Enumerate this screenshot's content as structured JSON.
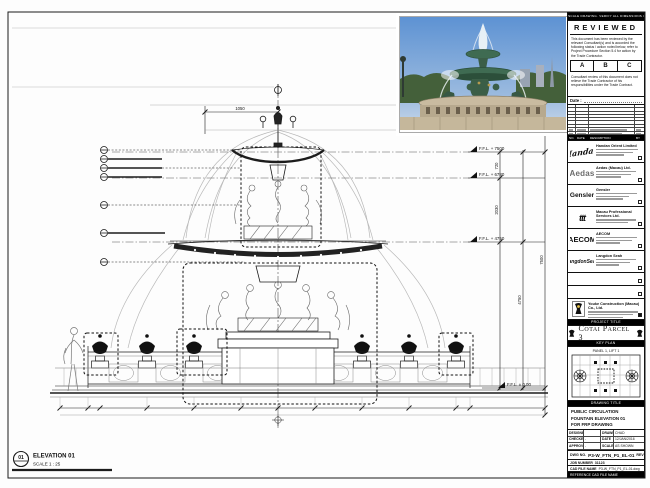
{
  "sheet_note": "DO NOT SCALE DRAWING. VERIFY ALL DIMENSIONS ON SITE.",
  "stamp": {
    "title": "REVIEWED",
    "body1": "This document has been reviewed by the relevant Consultant(s) and is accorded the following status / action noted below, refer to Project Procedure Section 5.4 for action by the Trade Contractor.",
    "options": [
      "A",
      "B",
      "C"
    ],
    "body2": "Consultant review of this document does not relieve the Trade Contractor of his responsibilities under the Trade Contract.",
    "date_label": "Date :"
  },
  "revisions": {
    "headers": [
      "NO.",
      "DATE",
      "DESCRIPTION",
      "BY"
    ]
  },
  "consultants": [
    {
      "logo": "Handan",
      "name": "Handan Orient Limited"
    },
    {
      "logo": "Aedas",
      "name": "Aedas (Macau) Ltd."
    },
    {
      "logo": "Gensler",
      "name": "Gensler"
    },
    {
      "logo": "ttt",
      "name": "Macau Professional Services Ltd."
    },
    {
      "logo": "AECOM",
      "name": "AECOM"
    },
    {
      "logo": "LangdonSeah",
      "name": "Langdon Seah"
    }
  ],
  "contractor": {
    "name": "Youke Construction (Macau) Co., Ltd."
  },
  "project": {
    "label": "PROJECT TITLE",
    "title": "Cotai Parcel 3"
  },
  "key_plan": {
    "label": "KEY PLAN",
    "note": "PANEL 1, LIFT 1"
  },
  "drawing_title": {
    "label": "DRAWING TITLE",
    "line1": "PUBLIC CIRCULATION",
    "line2": "FOUNTAIN ELEVATION 01",
    "line3": "FOR FRP DRAWING"
  },
  "fields": {
    "designed_label": "DESIGNED",
    "designed": "",
    "drawn_label": "DRAWN",
    "drawn": "CHAD",
    "checked_label": "CHECKED",
    "checked": "-",
    "date_label": "DATE",
    "date": "12/JAN/2016",
    "approved_label": "APPROVED",
    "approved": "-",
    "scale_label": "SCALE",
    "scale": "AS SHOWN"
  },
  "dwg": {
    "label": "DWG NO.",
    "value": "P3-W_FTN_P1_EL-01",
    "rev_label": "REV",
    "rev": "0"
  },
  "job": {
    "label": "JOB NUMBER",
    "value": "31123"
  },
  "cad": {
    "label": "CAD FILE NAME",
    "value": "P3-W_FTN_P1_EL-01.dwg"
  },
  "ref": {
    "label": "REFERENCE CAD FILE NAME"
  },
  "elevation_marker": {
    "bubble": "01",
    "title": "ELEVATION 01",
    "scale": "SCALE  1 : 25"
  },
  "levels": {
    "l1": "F.F.L. + 7500",
    "l2": "F.F.L. + 6780",
    "l3": "F.F.L. + 4750",
    "l0": "F.F.L. ± 0.00"
  },
  "dims": {
    "top_width": "1050",
    "seg1": "720",
    "seg2": "2030",
    "total1": "4750",
    "total2": "7500"
  },
  "colors": {
    "line": "#1c1c1c",
    "water": "#b9b9b9",
    "sky": "#6f9fd8",
    "foliage": "#3f5b35",
    "bronze": "#3f6b52",
    "stone": "#c9bba0"
  }
}
